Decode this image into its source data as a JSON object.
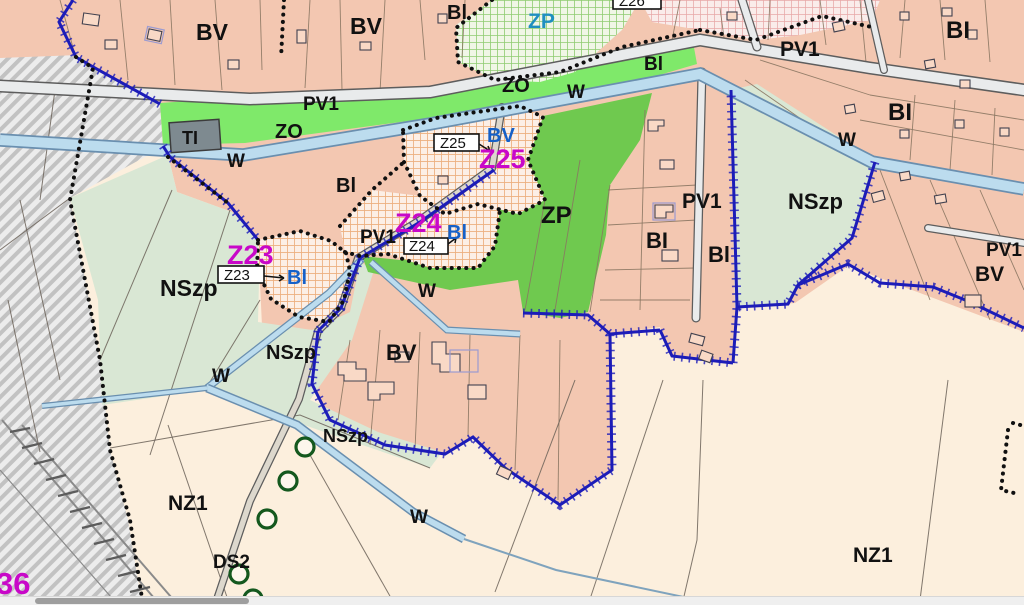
{
  "map": {
    "zones": {
      "bv": "BV",
      "bi": "BI",
      "bl": "Bl",
      "zp": "ZP",
      "zo": "ZO",
      "w": "W",
      "pv1": "PV1",
      "ti": "TI",
      "nszp": "NSzp",
      "nz1": "NZ1",
      "ds2": "DS2",
      "z23": "Z23",
      "z24": "Z24",
      "z25": "Z25",
      "z26": "Z26",
      "n36": "36"
    },
    "colors": {
      "residential_pink": "#f3c7b1",
      "green_zp": "#6fc94f",
      "green_zo": "#7fe96a",
      "pale_green_nszp": "#d9e7d4",
      "cream_nz1": "#fcefdd",
      "water_blue": "#bcdcee",
      "plan_boundary_navy": "#1c1cb8",
      "zone_boundary_black": "#101010",
      "checkered_orange": "#edaf7e",
      "checkered_green": "#8fcc70",
      "checkered_pink": "#e8a8a8",
      "magenta_label": "#c808c8",
      "blue_label": "#1560c8",
      "cyan_label": "#1f8fc0",
      "railway_gray": "#ececec",
      "ti_gray": "#7e8a90"
    }
  }
}
